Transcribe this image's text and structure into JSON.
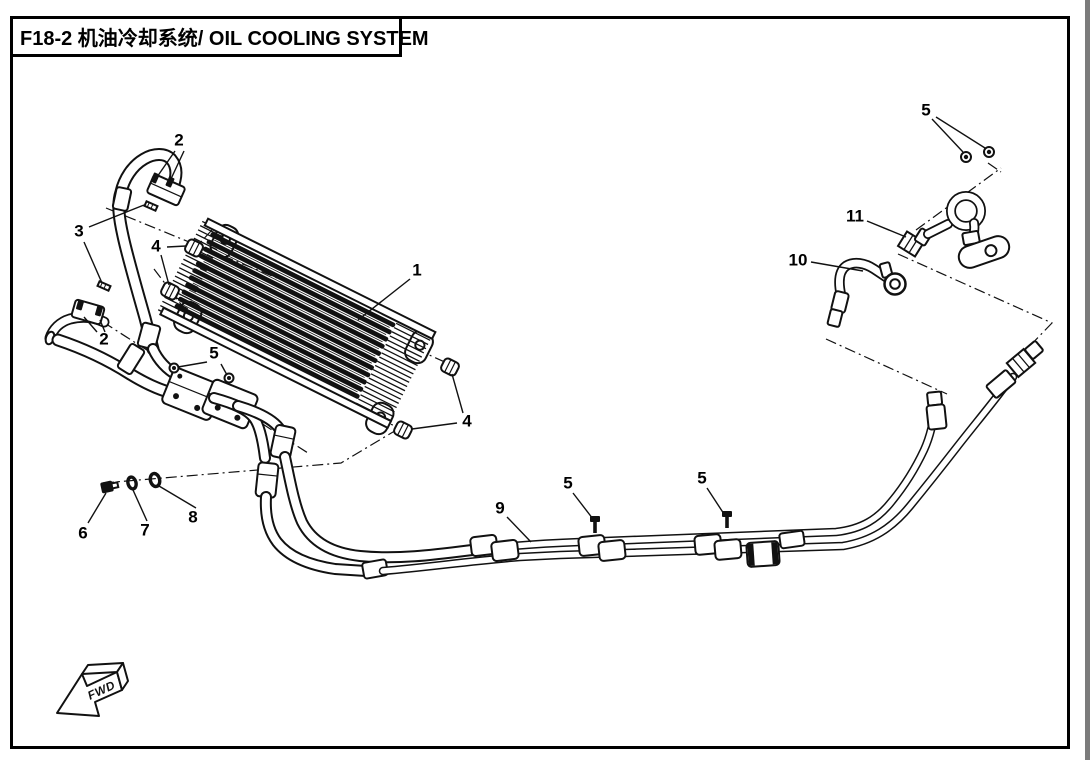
{
  "window": {
    "background_color": "#ffffff",
    "line_color": "#111111",
    "right_edge_strip_color": "#7b7b7b"
  },
  "header": {
    "title_full": "F18-2 机油冷却系统/ OIL COOLING SYSTEM",
    "section_code": "F18-2",
    "title_zh": "机油冷却系统",
    "title_en": "OIL COOLING SYSTEM"
  },
  "diagram": {
    "fwd_label": "FWD",
    "callouts": [
      {
        "ref": "1",
        "x": 417,
        "y": 270
      },
      {
        "ref": "2",
        "x": 179,
        "y": 140
      },
      {
        "ref": "3",
        "x": 79,
        "y": 231
      },
      {
        "ref": "4",
        "x": 156,
        "y": 246
      },
      {
        "ref": "2",
        "x": 104,
        "y": 339
      },
      {
        "ref": "5",
        "x": 214,
        "y": 353
      },
      {
        "ref": "4",
        "x": 467,
        "y": 421
      },
      {
        "ref": "6",
        "x": 83,
        "y": 533
      },
      {
        "ref": "7",
        "x": 145,
        "y": 530
      },
      {
        "ref": "8",
        "x": 193,
        "y": 517
      },
      {
        "ref": "9",
        "x": 500,
        "y": 508
      },
      {
        "ref": "5",
        "x": 568,
        "y": 483
      },
      {
        "ref": "5",
        "x": 702,
        "y": 478
      },
      {
        "ref": "10",
        "x": 798,
        "y": 260
      },
      {
        "ref": "11",
        "x": 855,
        "y": 216
      },
      {
        "ref": "5",
        "x": 926,
        "y": 110
      }
    ]
  }
}
